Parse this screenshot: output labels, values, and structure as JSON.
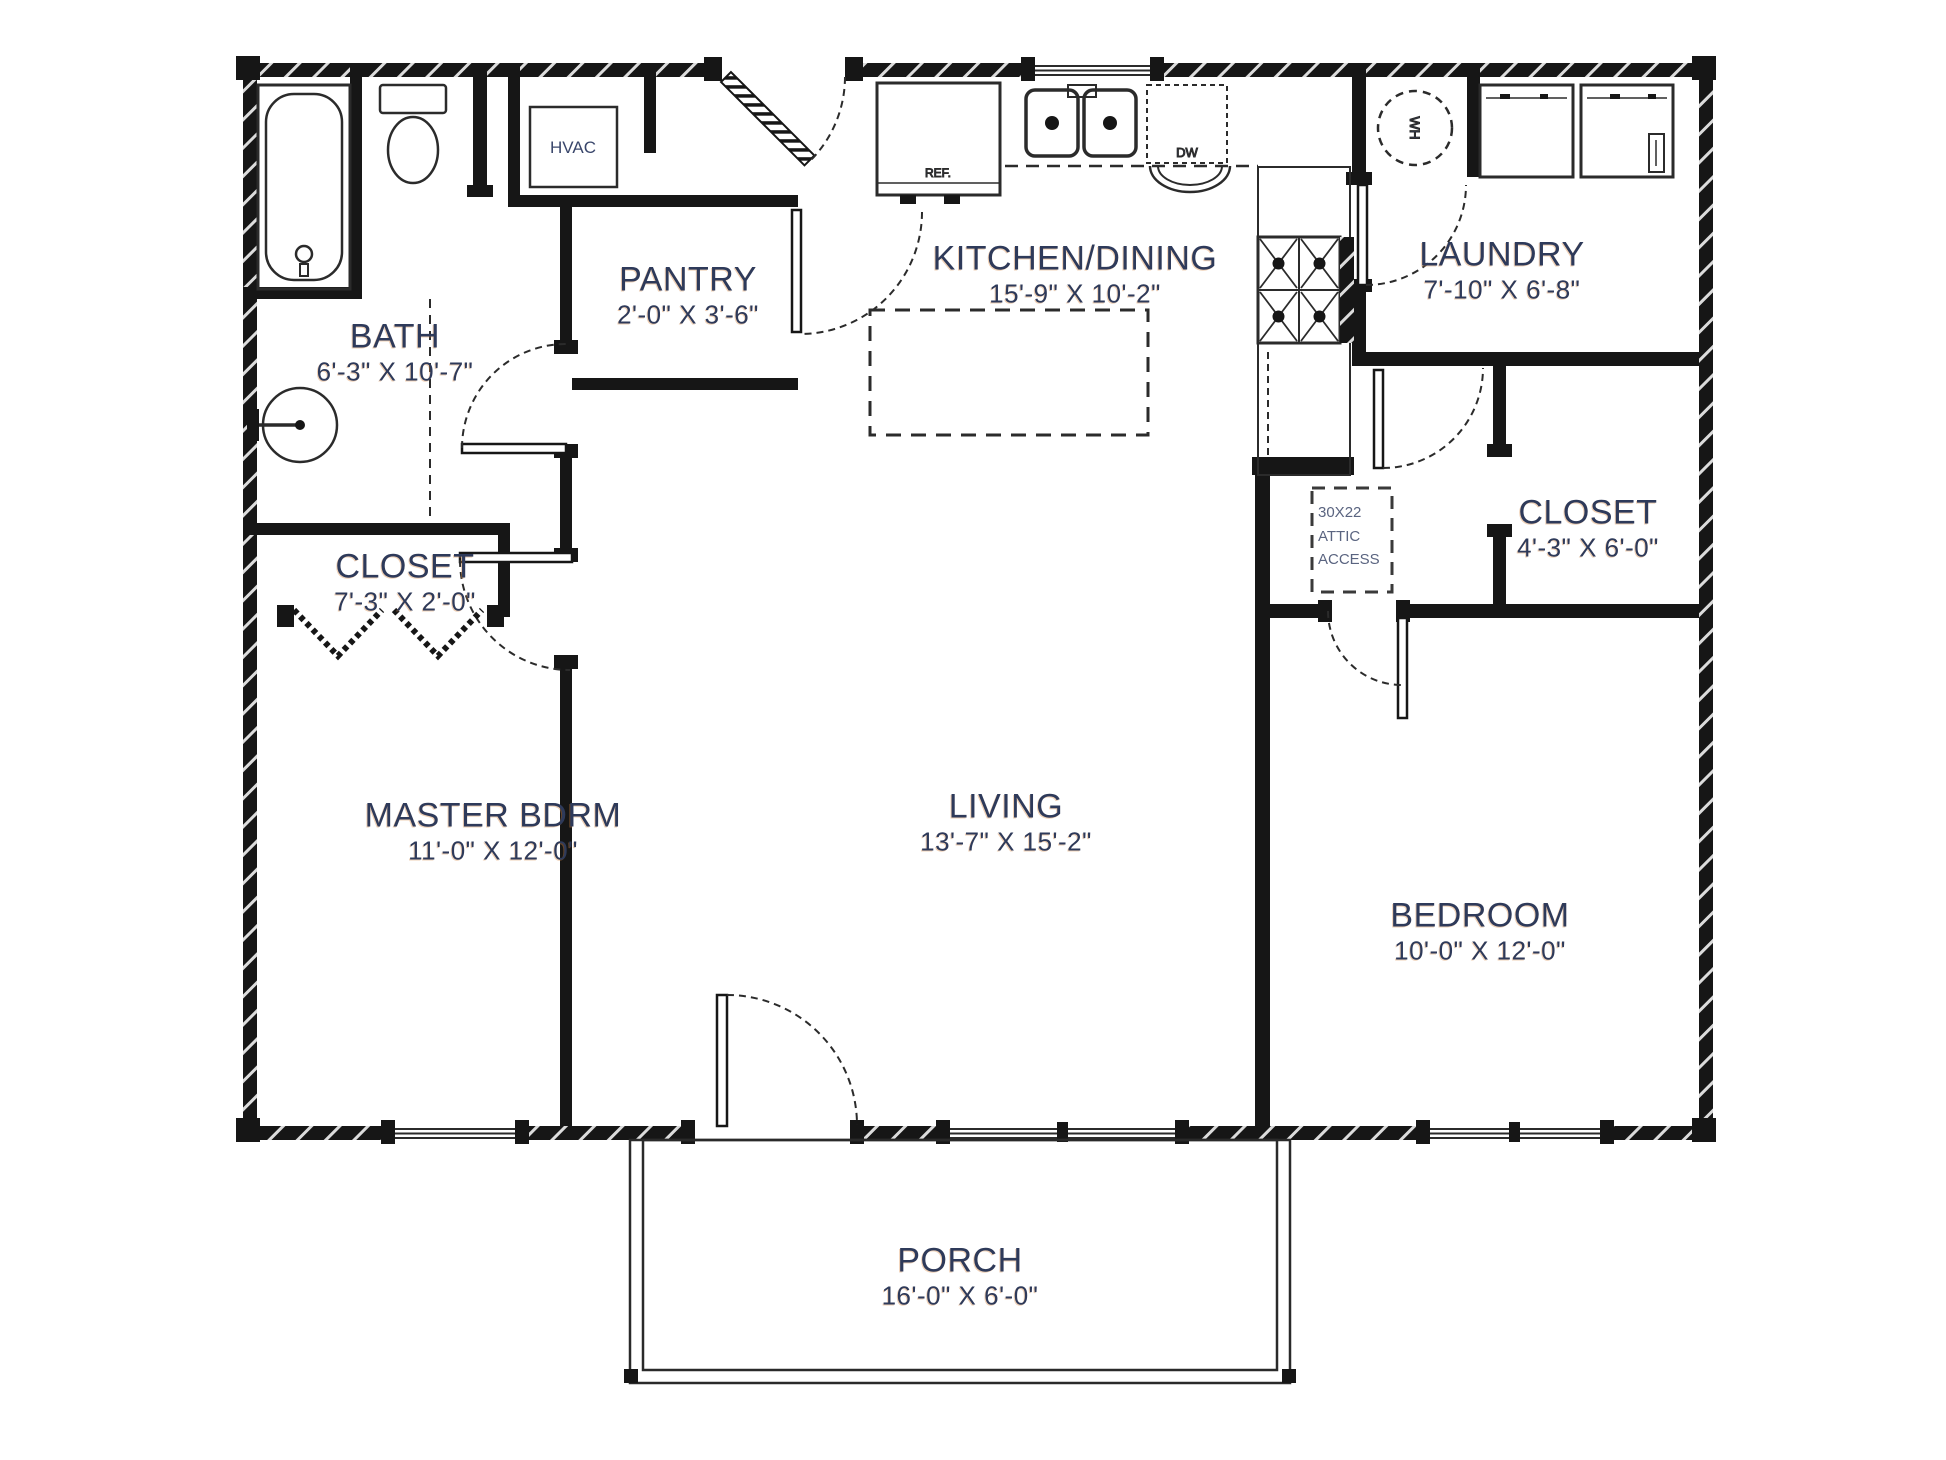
{
  "rooms": [
    {
      "id": "bath",
      "name": "BATH",
      "dims": "6'-3\" X 10'-7\""
    },
    {
      "id": "pantry",
      "name": "PANTRY",
      "dims": "2'-0\" X 3'-6\""
    },
    {
      "id": "kitchen-dining",
      "name": "KITCHEN/DINING",
      "dims": "15'-9\" X 10'-2\""
    },
    {
      "id": "laundry",
      "name": "LAUNDRY",
      "dims": "7'-10\" X 6'-8\""
    },
    {
      "id": "master-closet",
      "name": "CLOSET",
      "dims": "7'-3\" X 2'-0\""
    },
    {
      "id": "bedroom-closet",
      "name": "CLOSET",
      "dims": "4'-3\" X 6'-0\""
    },
    {
      "id": "master-bedroom",
      "name": "MASTER BDRM",
      "dims": "11'-0\" X 12'-0\""
    },
    {
      "id": "living",
      "name": "LIVING",
      "dims": "13'-7\" X 15'-2\""
    },
    {
      "id": "bedroom",
      "name": "BEDROOM",
      "dims": "10'-0\" X 12'-0\""
    },
    {
      "id": "porch",
      "name": "PORCH",
      "dims": "16'-0\" X 6'-0\""
    }
  ],
  "appliances": {
    "hvac": "HVAC",
    "refrigerator": "REF.",
    "dishwasher": "DW",
    "water_heater": "WH",
    "attic_access_line1": "30X22",
    "attic_access_line2": "ATTIC",
    "attic_access_line3": "ACCESS"
  },
  "colors": {
    "wall": "#1a1a1a",
    "label": "#2e3a5a",
    "background": "#ffffff"
  }
}
